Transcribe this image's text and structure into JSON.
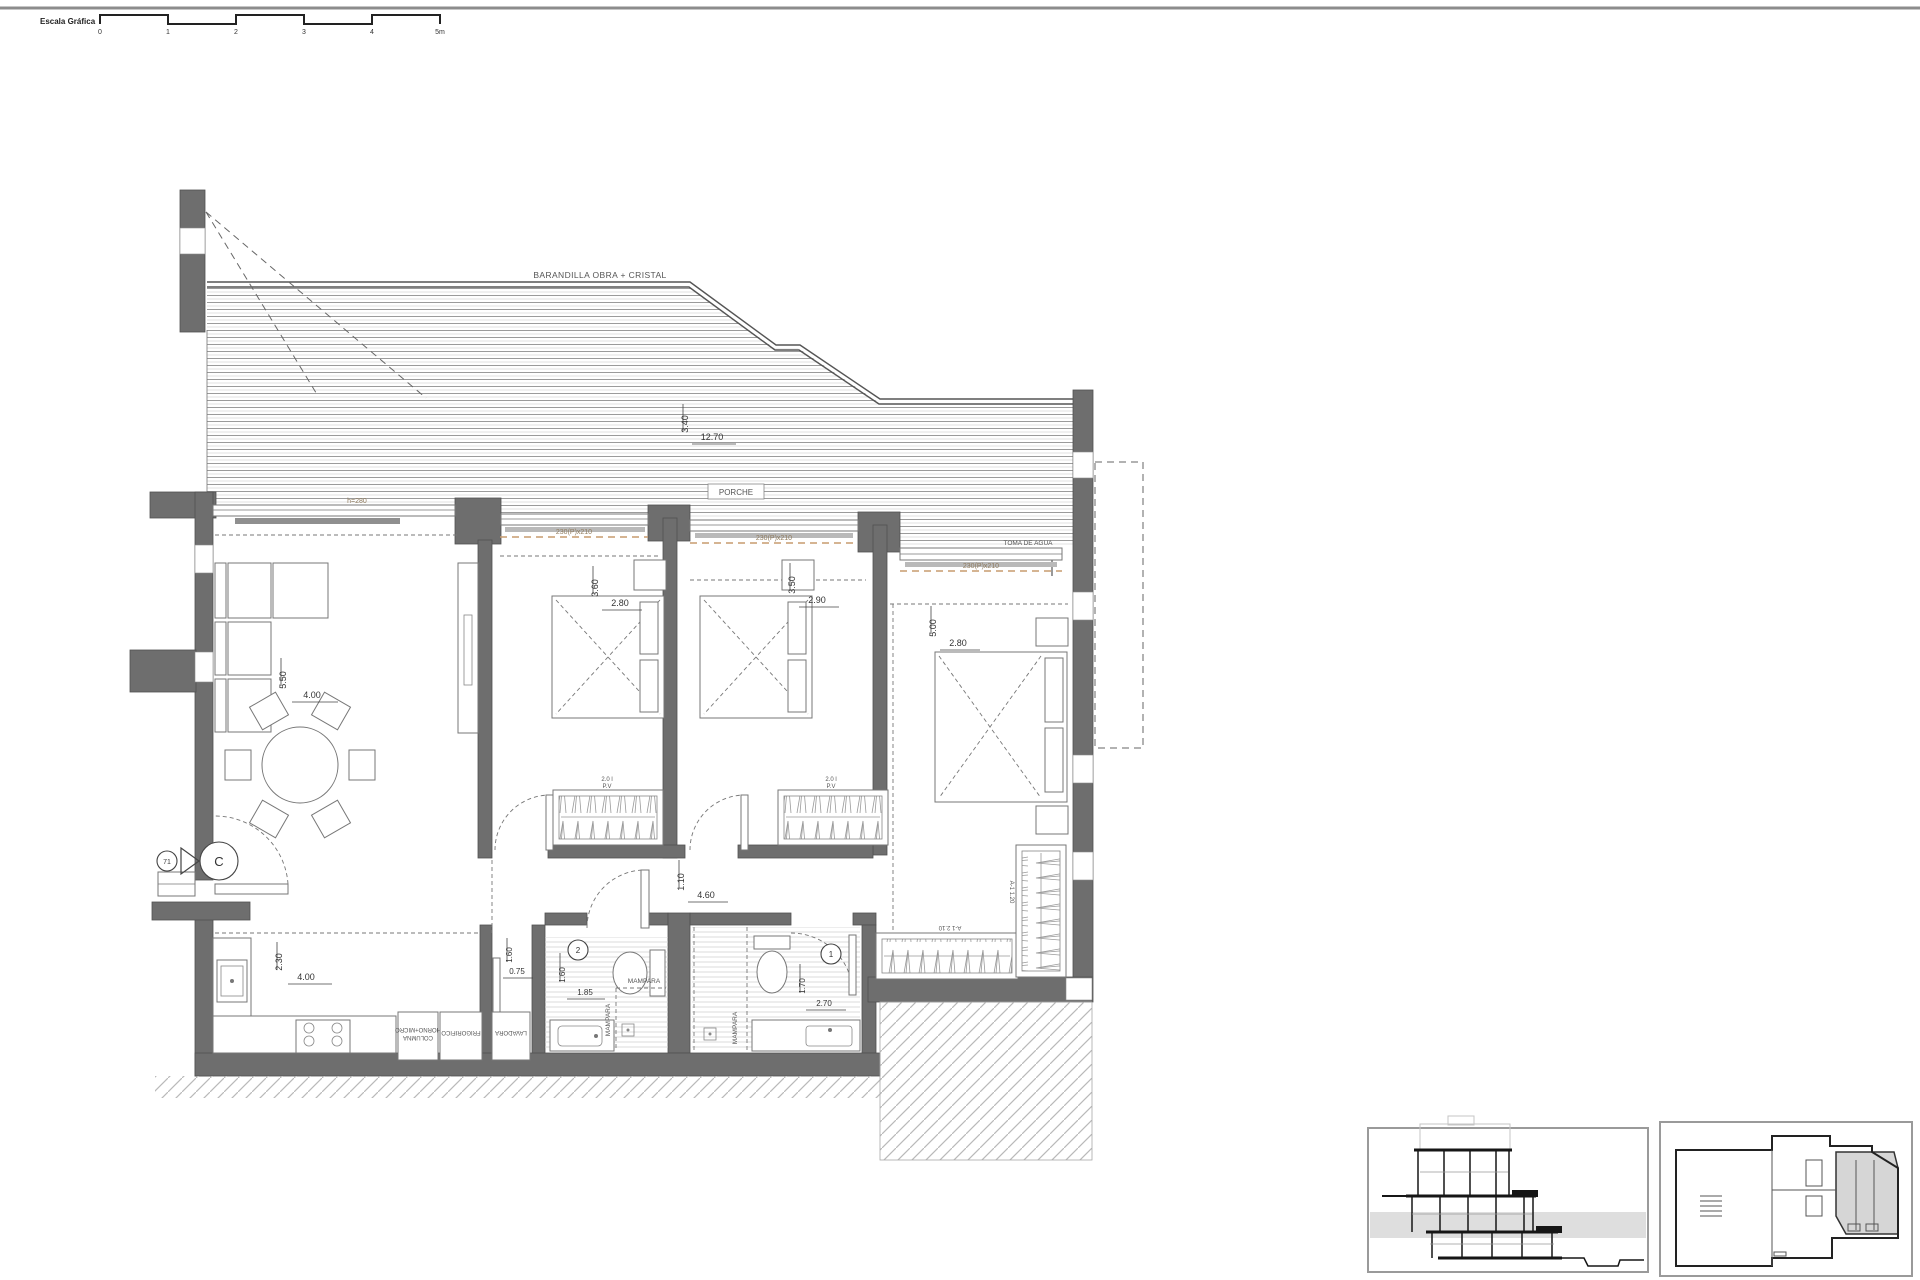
{
  "colors": {
    "wall": "#6e6e6e",
    "window_dim_accent": "#c79b6e",
    "highlight_unit": "#d6d6d6"
  },
  "scale": {
    "label": "Escala Gráfica",
    "ticks": [
      "0",
      "1",
      "2",
      "3",
      "4",
      "5m"
    ]
  },
  "terrace": {
    "railing_label": "BARANDILLA OBRA + CRISTAL",
    "porch_label": "PORCHE",
    "dim_v": "3.40",
    "dim_h": "12.70",
    "water_tap": "TOMA DE AGUA",
    "window_height": "h=280"
  },
  "windows": {
    "w1": "230(P)x210",
    "w2": "230(P)x210",
    "w3": "230(P)x210"
  },
  "rooms": {
    "living": {
      "dim_v": "5.50",
      "dim_h": "4.00"
    },
    "kitchen": {
      "dim_v": "2.30",
      "dim_h": "4.00",
      "unit_column_line1": "COLUMNA",
      "unit_column_line2": "HORNO+MICRO",
      "unit_fridge": "FRIGORIFICO",
      "unit_washer": "LAVADORA"
    },
    "laundry": {
      "dim_v": "1.60",
      "dim_h": "0.75"
    },
    "bedroom1": {
      "dim_v": "3.60",
      "dim_h": "2.80",
      "ward_line1": "2.0 l",
      "ward_line2": "P.V"
    },
    "bedroom2": {
      "dim_v": "3.50",
      "dim_h": "2.90",
      "ward_line1": "2.0 l",
      "ward_line2": "P.V"
    },
    "master": {
      "dim_v": "5.00",
      "dim_h": "2.80",
      "wardrobe_bottom": "A-1 2.10",
      "wardrobe_side": "A-1 1.20"
    },
    "hall": {
      "dim_v": "1.10",
      "dim_h": "4.60"
    },
    "bath1": {
      "number": "1",
      "dim_v": "1.70",
      "dim_h": "2.70",
      "screen": "MAMPARA"
    },
    "bath2": {
      "number": "2",
      "dim_v": "1.60",
      "dim_h": "1.85",
      "screen_v": "MAMPARA",
      "screen_h": "MAMPARA"
    }
  },
  "section_marker": {
    "number": "71",
    "letter": "C"
  }
}
